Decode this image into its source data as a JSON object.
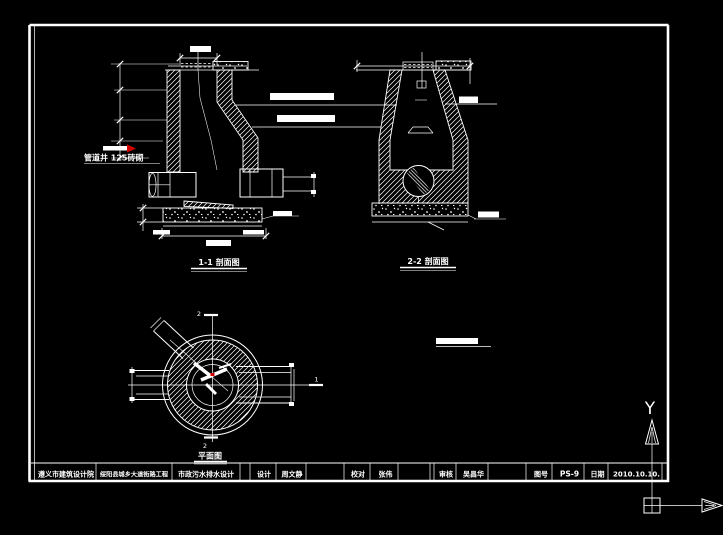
{
  "drawing": {
    "section1": {
      "label": "1-1 剖面图",
      "note": "管道井 125砖砌"
    },
    "section2": {
      "label": "2-2 剖面图"
    },
    "plan": {
      "label": "平面图",
      "marker_top": "2",
      "marker_bottom": "2",
      "marker_right": "1"
    },
    "ucs": {
      "axis_label": "Y"
    }
  },
  "title_block": {
    "design_institute": "遵义市建筑设计院",
    "project_name": "绥阳县城乡大道街路工程",
    "design_content": "市政污水排水设计",
    "fields": [
      {
        "label": "设计",
        "value": "周文静"
      },
      {
        "label": "校对",
        "value": "张伟"
      },
      {
        "label": "审核",
        "value": "吴昌华"
      },
      {
        "label": "图号",
        "value": "PS-9"
      },
      {
        "label": "日期",
        "value": "2010.10.10."
      }
    ]
  },
  "colors": {
    "background": "#000000",
    "line": "#ffffff",
    "accent": "#d40000"
  }
}
